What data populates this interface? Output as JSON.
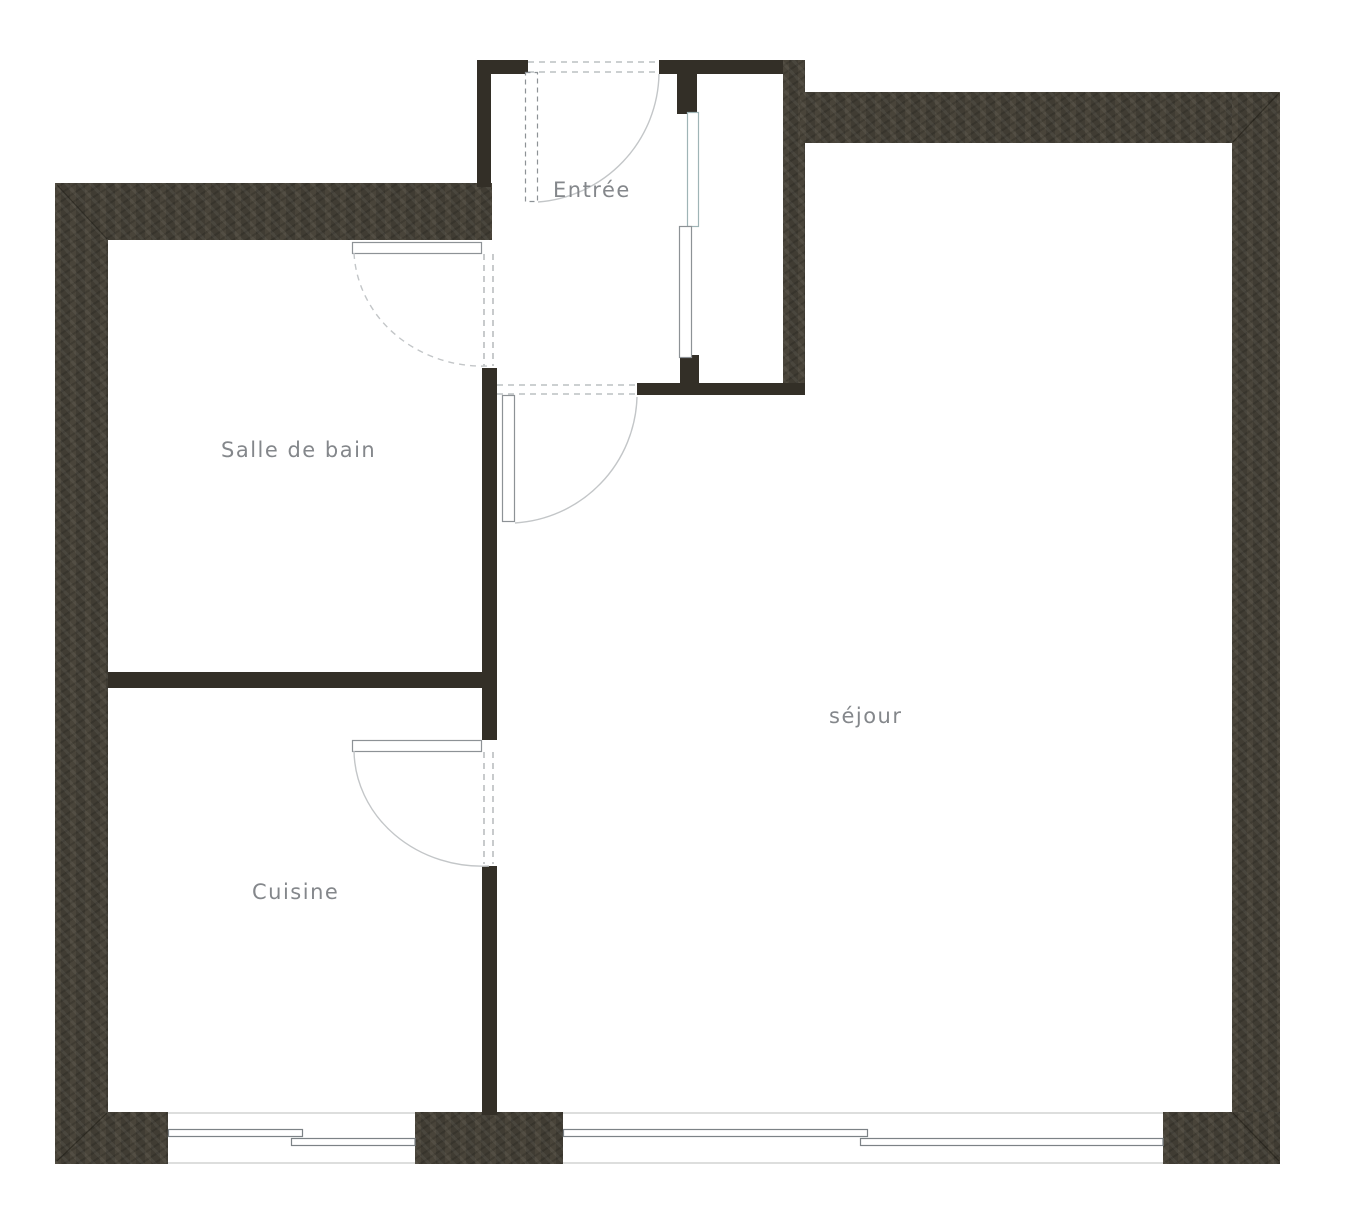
{
  "rooms": {
    "entree": {
      "label": "Entrée"
    },
    "salle_de_bain": {
      "label": "Salle de bain"
    },
    "sejour": {
      "label": "séjour"
    },
    "cuisine": {
      "label": "Cuisine"
    }
  },
  "colors": {
    "background": "#ffffff",
    "wall": "#403c33",
    "wall_interior": "#332f27",
    "door_line": "#8d9296",
    "arc_line": "#c3c6c8",
    "dash_line": "#9aa0a3",
    "window_line": "#7c8286",
    "window_band": "#d2d4d2",
    "sliding_panel_line": "#9fb4b6",
    "label_text": "#84878b"
  }
}
